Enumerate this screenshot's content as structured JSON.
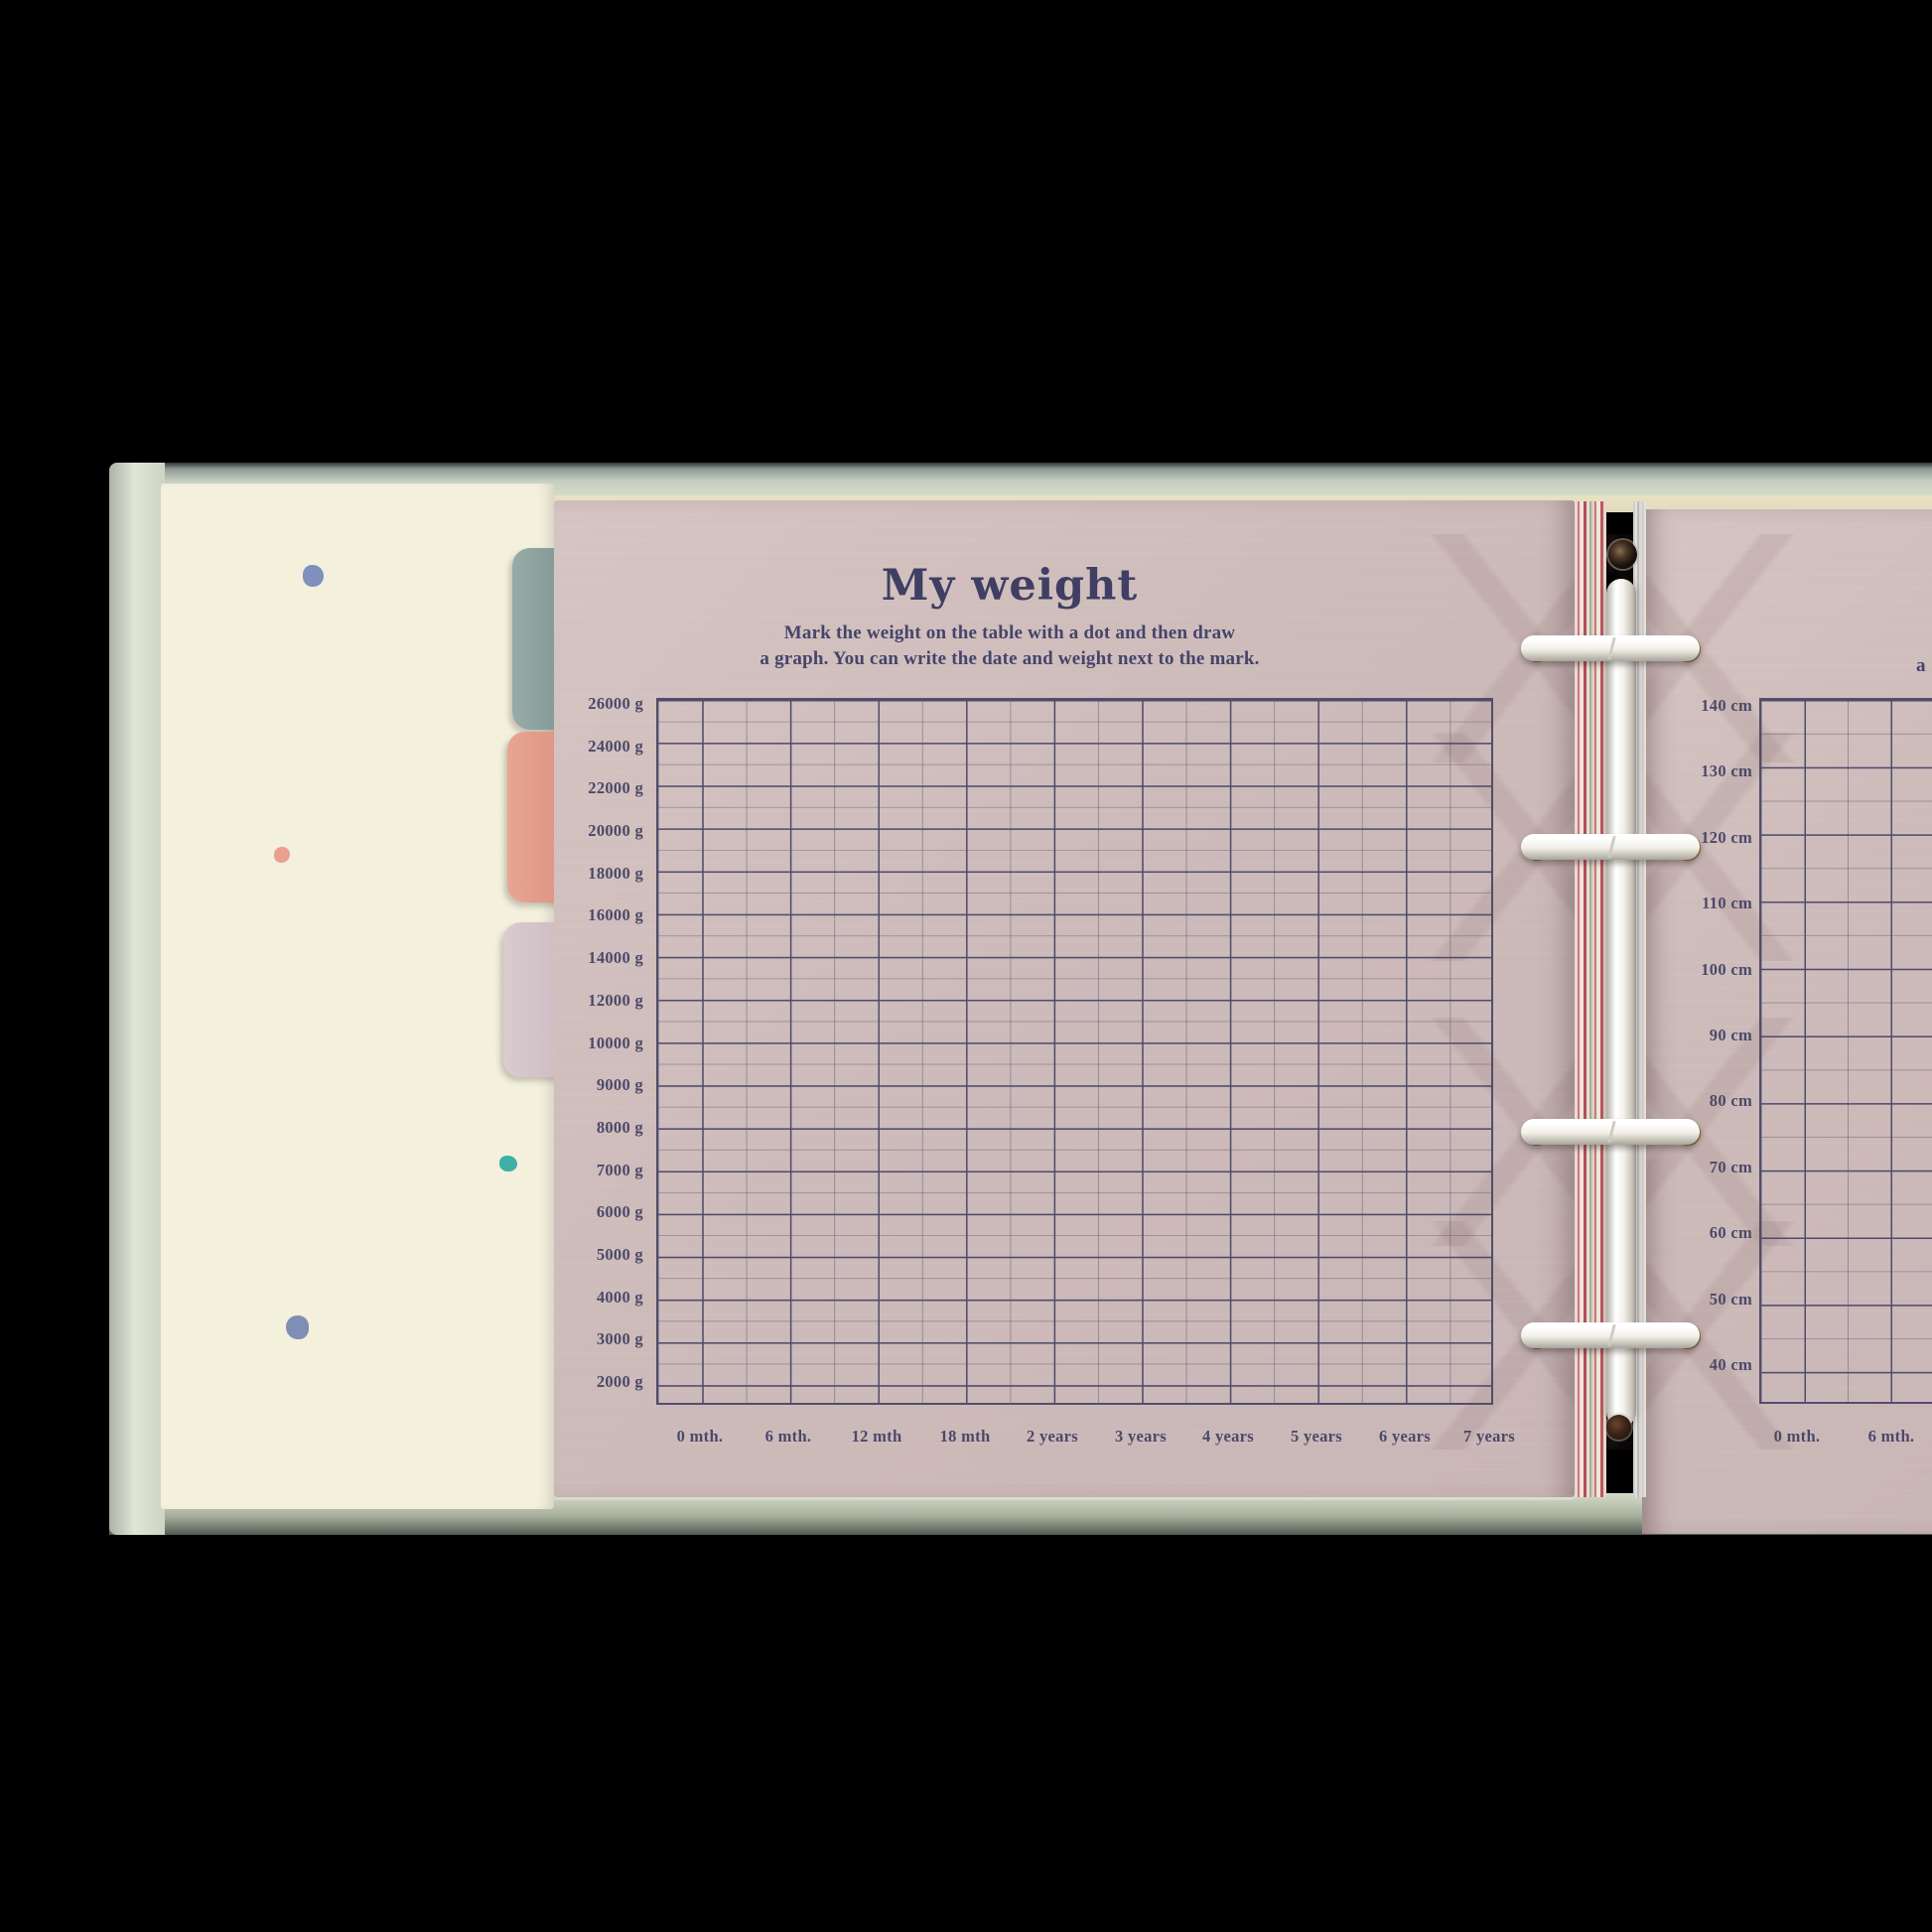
{
  "scene": {
    "description_labels": {
      "binder": "open ring binder",
      "left_inner_cover": "cream inner cover with paint dots",
      "spine": "white four-ring mechanism with striped page stack"
    }
  },
  "colors": {
    "background": "#000000",
    "cover_sage": "#cdd4c3",
    "cream_page": "#f3f0dc",
    "pink_page": "#cdbbba",
    "ink_navy": "#45446a",
    "tab_teal": "#8aa09d",
    "tab_salmon": "#e29a88",
    "tab_lavender": "#d4c5cb",
    "dot_blue": "#8090bc",
    "dot_salmon": "#eb9f8e",
    "dot_teal": "#3fb0a8",
    "stripe_red": "#b05058"
  },
  "chart_data": [
    {
      "type": "grid",
      "title": "My weight",
      "subtitle_lines": [
        "Mark the weight on the table with a dot and then draw",
        "a graph. You can write the date and weight next to the mark."
      ],
      "yticks": [
        "26000 g",
        "24000 g",
        "22000 g",
        "20000 g",
        "18000 g",
        "16000 g",
        "14000 g",
        "12000 g",
        "10000 g",
        "9000 g",
        "8000 g",
        "7000 g",
        "6000 g",
        "5000 g",
        "4000 g",
        "3000 g",
        "2000 g"
      ],
      "xticks": [
        "0 mth.",
        "6 mth.",
        "12 mth",
        "18 mth",
        "2 years",
        "3 years",
        "4 years",
        "5 years",
        "6 years",
        "7 years"
      ],
      "ylim": [
        2000,
        26000
      ],
      "xlabel": "",
      "ylabel": "",
      "grid": true,
      "legend": "none",
      "values": [],
      "note": "blank tracking template — no data points plotted"
    },
    {
      "type": "grid",
      "instruction_fragment": "a",
      "yticks": [
        "140 cm",
        "130 cm",
        "120 cm",
        "110 cm",
        "100 cm",
        "90 cm",
        "80 cm",
        "70 cm",
        "60 cm",
        "50 cm",
        "40 cm"
      ],
      "xticks": [
        "0 mth.",
        "6 mth."
      ],
      "ylim": [
        40,
        140
      ],
      "grid": true,
      "values": [],
      "note": "height chart page, partially visible at right edge"
    }
  ]
}
